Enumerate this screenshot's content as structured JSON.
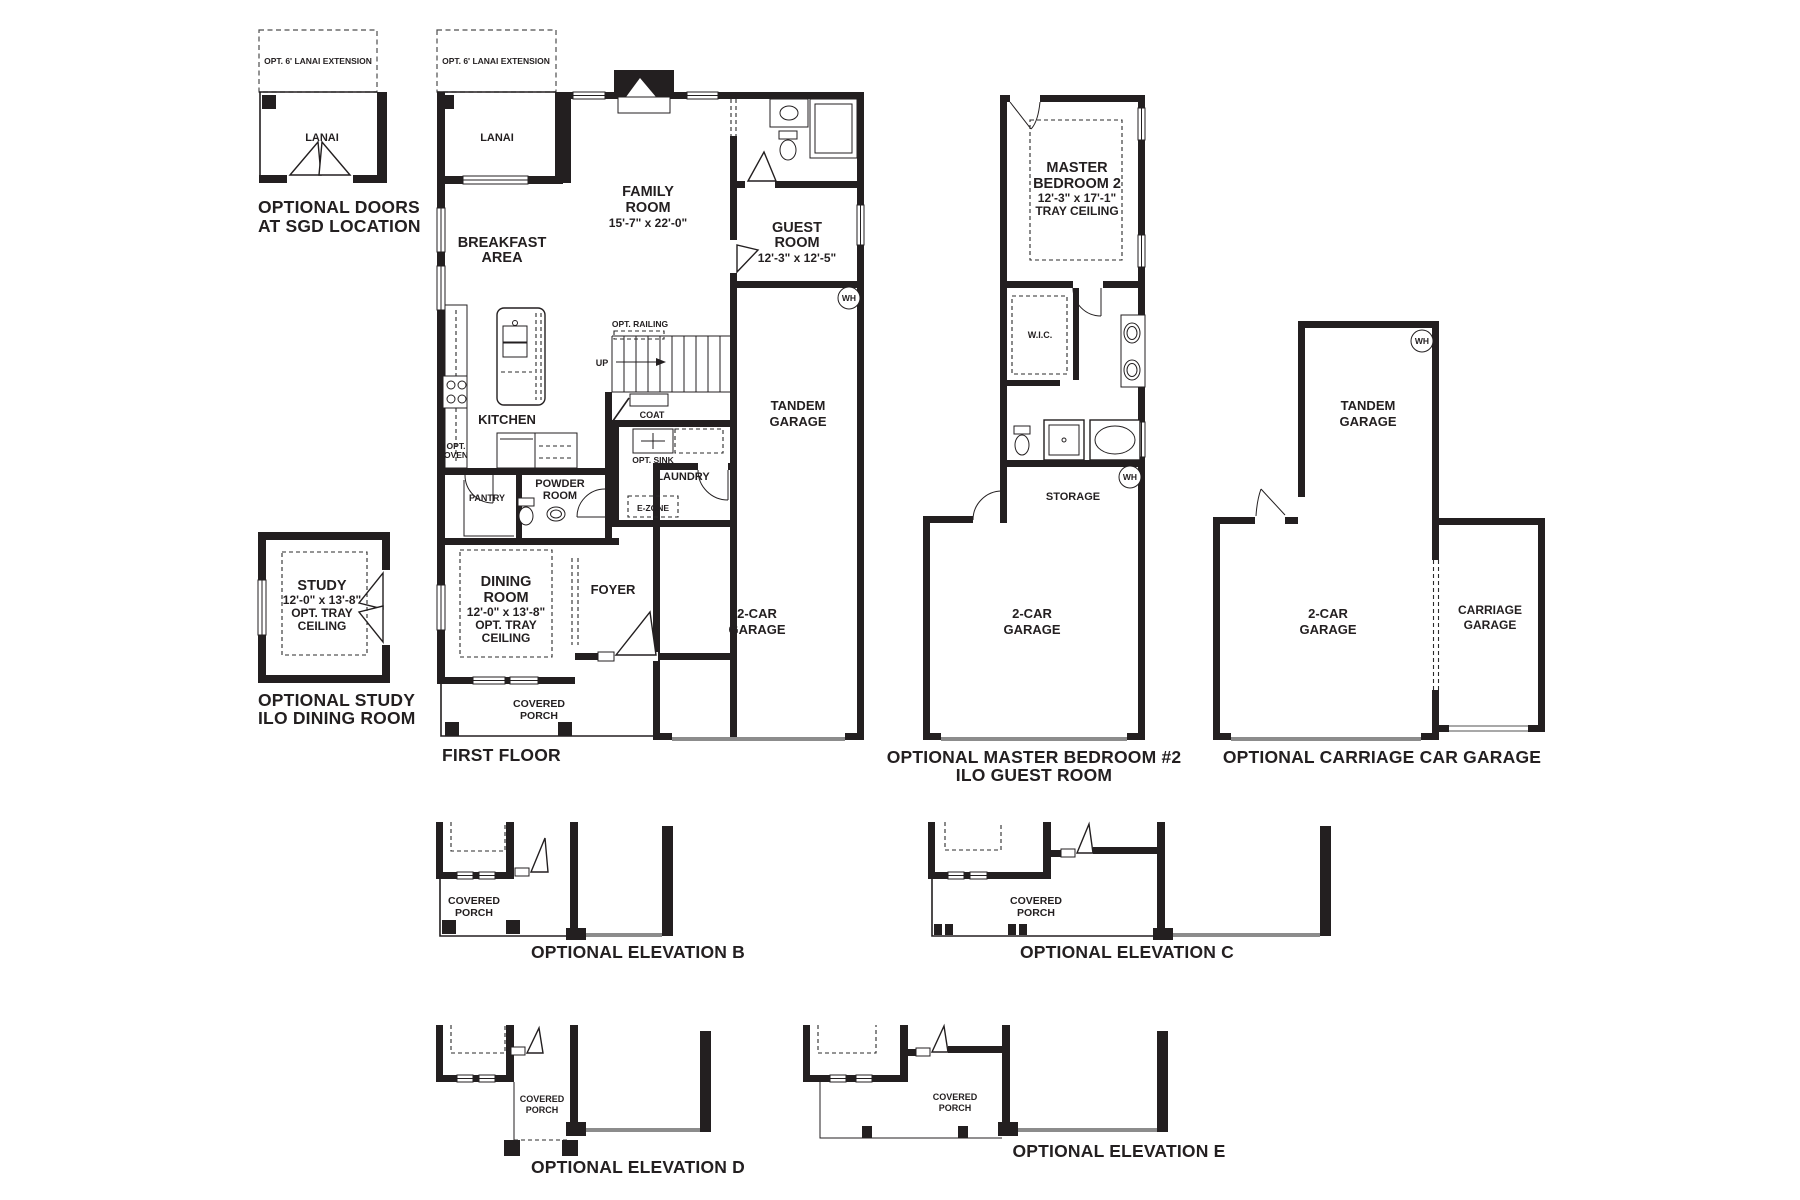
{
  "colors": {
    "wall": "#231f20",
    "garage_door_line": "#8c8c8c",
    "dashed": "#4d4d4d",
    "background": "#ffffff"
  },
  "sgd_plan": {
    "ext": "OPT. 6' LANAI EXTENSION",
    "lanai": "LANAI",
    "ca ption": "",
    "caption_l1": "OPTIONAL DOORS",
    "caption_l2": "AT SGD LOCATION"
  },
  "first_floor": {
    "ext": "OPT. 6' LANAI EXTENSION",
    "lanai": "LANAI",
    "family_l1": "FAMILY",
    "family_l2": "ROOM",
    "family_dim": "15'-7\" x 22'-0\"",
    "breakfast_l1": "BREAKFAST",
    "breakfast_l2": "AREA",
    "guest_l1": "GUEST",
    "guest_l2": "ROOM",
    "guest_dim": "12'-3\" x 12'-5\"",
    "kitchen": "KITCHEN",
    "opt_oven_l1": "OPT.",
    "opt_oven_l2": "OVEN",
    "pantry": "PANTRY",
    "powder_l1": "POWDER",
    "powder_l2": "ROOM",
    "opt_railing": "OPT. RAILING",
    "up": "UP",
    "coat": "COAT",
    "opt_sink": "OPT. SINK",
    "laundry": "LAUNDRY",
    "ezone": "E-ZONE",
    "tandem_l1": "TANDEM",
    "tandem_l2": "GARAGE",
    "two_car_l1": "2-CAR",
    "two_car_l2": "GARAGE",
    "wh": "WH",
    "dining_l1": "DINING",
    "dining_l2": "ROOM",
    "dining_dim": "12'-0\" x 13'-8\"",
    "dining_l3": "OPT. TRAY",
    "dining_l4": "CEILING",
    "foyer": "FOYER",
    "porch_l1": "COVERED",
    "porch_l2": "PORCH",
    "caption": "FIRST FLOOR"
  },
  "study_plan": {
    "study": "STUDY",
    "dim": "12'-0\" x 13'-8\"",
    "l3": "OPT. TRAY",
    "l4": "CEILING",
    "caption_l1": "OPTIONAL STUDY",
    "caption_l2": "ILO DINING ROOM"
  },
  "master_plan": {
    "l1": "MASTER",
    "l2": "BEDROOM 2",
    "dim": "12'-3\" x 17'-1\"",
    "l3": "TRAY CEILING",
    "wic": "W.I.C.",
    "storage": "STORAGE",
    "wh": "WH",
    "two_car_l1": "2-CAR",
    "two_car_l2": "GARAGE",
    "caption_l1": "OPTIONAL MASTER BEDROOM #2",
    "caption_l2": "ILO GUEST ROOM"
  },
  "carriage_plan": {
    "tandem_l1": "TANDEM",
    "tandem_l2": "GARAGE",
    "wh": "WH",
    "two_car_l1": "2-CAR",
    "two_car_l2": "GARAGE",
    "carriage_l1": "CARRIAGE",
    "carriage_l2": "GARAGE",
    "caption": "OPTIONAL CARRIAGE CAR GARAGE"
  },
  "elevations": {
    "b": {
      "porch_l1": "COVERED",
      "porch_l2": "PORCH",
      "caption": "OPTIONAL ELEVATION B"
    },
    "c": {
      "porch_l1": "COVERED",
      "porch_l2": "PORCH",
      "caption": "OPTIONAL ELEVATION C"
    },
    "d": {
      "porch_l1": "COVERED",
      "porch_l2": "PORCH",
      "caption": "OPTIONAL ELEVATION D"
    },
    "e": {
      "porch_l1": "COVERED",
      "porch_l2": "PORCH",
      "caption": "OPTIONAL ELEVATION E"
    }
  }
}
